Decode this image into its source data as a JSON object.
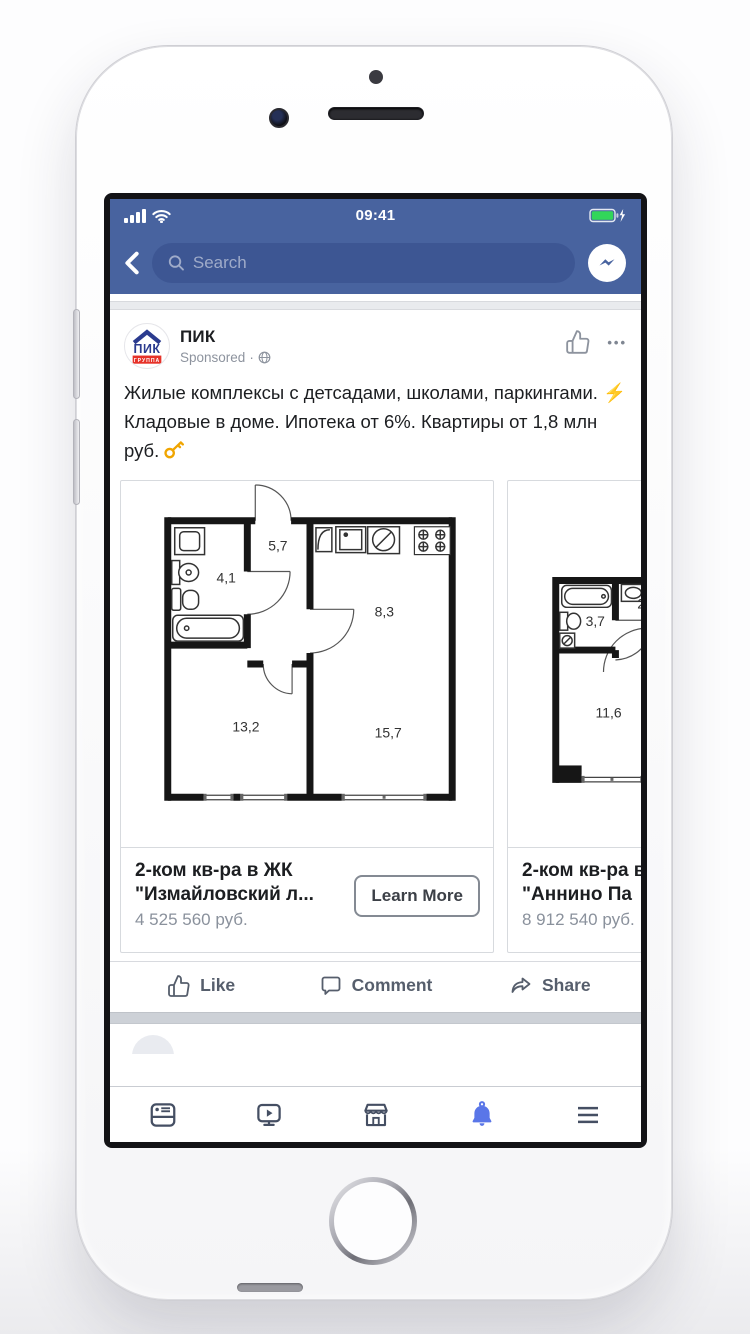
{
  "status_bar": {
    "time": "09:41"
  },
  "fb_header": {
    "search_placeholder": "Search"
  },
  "post": {
    "author": "ПИК",
    "logo_text": "ПИК",
    "logo_subtext": "ГРУППА",
    "sponsored": "Sponsored",
    "menu_dots": "•••",
    "body_1": "Жилые комплексы с детсадами, школами, паркингами. ",
    "emoji_bolt": "⚡",
    "body_2": " Кладовые в доме. Ипотека от 6%. Квартиры от 1,8 млн руб. ",
    "emoji_key": "🔑"
  },
  "carousel": {
    "cards": [
      {
        "title": "2-ком кв-ра в ЖК \"Измайловский л...",
        "price": "4 525 560 руб.",
        "cta": "Learn More",
        "areas": {
          "hall": "5,7",
          "bath": "4,1",
          "kitchen": "8,3",
          "room1": "13,2",
          "room2": "15,7"
        }
      },
      {
        "title": "2-ком кв-ра в ЖК \"Аннино Па",
        "price": "8 912 540 руб.",
        "cta": "Learn More",
        "areas": {
          "bath": "3,7",
          "partial": "2,",
          "room1": "11,6"
        }
      }
    ]
  },
  "actions": {
    "like": "Like",
    "comment": "Comment",
    "share": "Share"
  },
  "colors": {
    "fb_blue": "#48639F",
    "search_pill_blue": "#3D5693",
    "battery_green": "#32D65A",
    "active_tab_blue": "#5A76E8",
    "logo_navy": "#2B3B8F",
    "logo_red": "#E63229"
  }
}
